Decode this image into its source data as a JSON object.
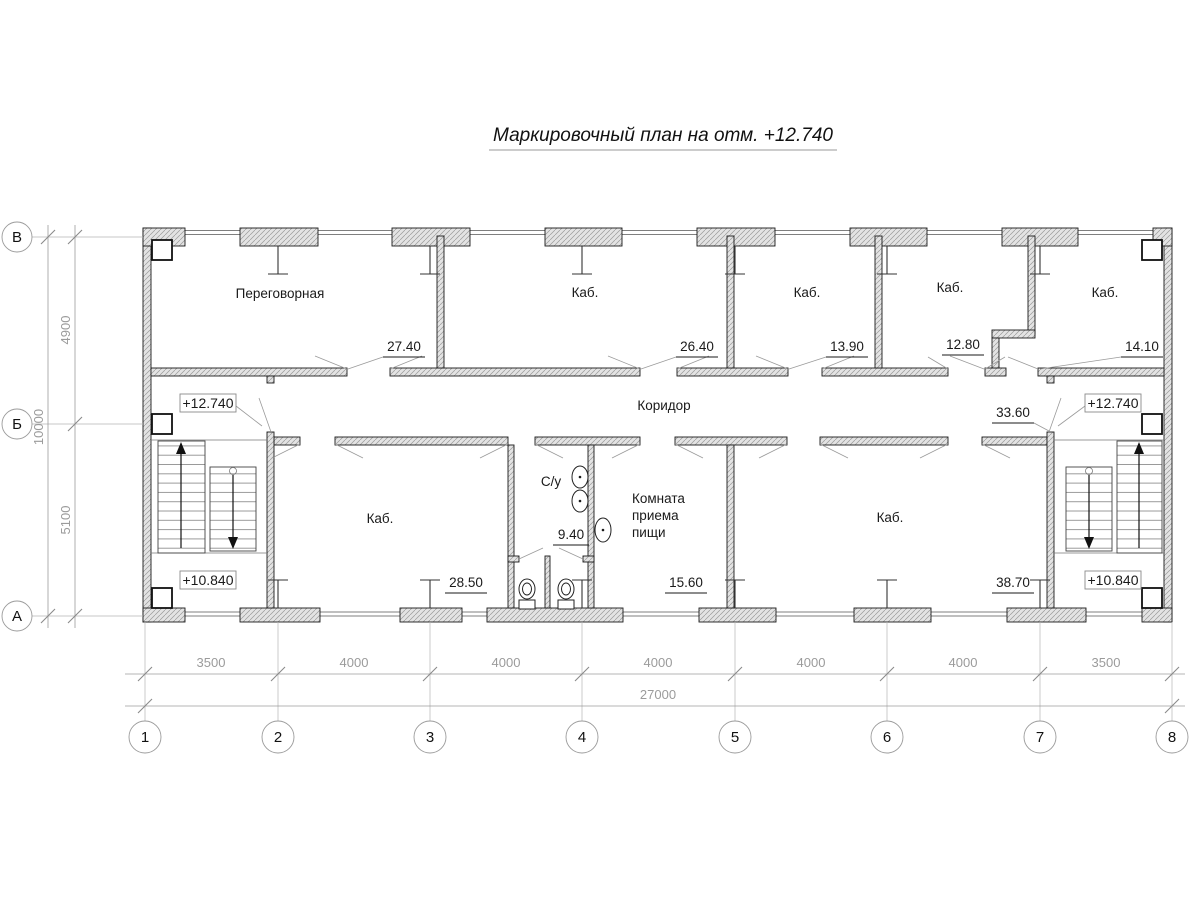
{
  "title": "Маркировочный план на отм. +12.740",
  "axes": {
    "vertical": [
      "В",
      "Б",
      "А"
    ],
    "horizontal": [
      "1",
      "2",
      "3",
      "4",
      "5",
      "6",
      "7",
      "8"
    ]
  },
  "dimensions": {
    "left_segments": [
      "4900",
      "5100"
    ],
    "left_total": "10000",
    "bottom_segments": [
      "3500",
      "4000",
      "4000",
      "4000",
      "4000",
      "4000",
      "3500"
    ],
    "bottom_total": "27000"
  },
  "elevations": {
    "upper": "+12.740",
    "lower": "+10.840"
  },
  "rooms": {
    "peregovornaya": {
      "name": "Переговорная",
      "area": "27.40"
    },
    "kab_top_2": {
      "name": "Каб.",
      "area": "26.40"
    },
    "kab_top_3": {
      "name": "Каб.",
      "area": "13.90"
    },
    "kab_top_4": {
      "name": "Каб.",
      "area": "12.80"
    },
    "kab_top_5": {
      "name": "Каб.",
      "area": "14.10"
    },
    "corridor": {
      "name": "Коридор",
      "area": "33.60"
    },
    "kab_bottom_left": {
      "name": "Каб.",
      "area": "28.50"
    },
    "sanuzel": {
      "name": "С/у",
      "area": "9.40"
    },
    "komnata_priema_pischi": {
      "name_lines": [
        "Комната",
        "приема",
        "пищи"
      ],
      "area": "15.60"
    },
    "kab_bottom_right": {
      "name": "Каб.",
      "area": "38.70"
    }
  },
  "colors": {
    "wall_outline": "#1a1a1a",
    "dimension": "#9b9b9b",
    "leader": "#9b9b9b",
    "text": "#1a1a1a"
  }
}
